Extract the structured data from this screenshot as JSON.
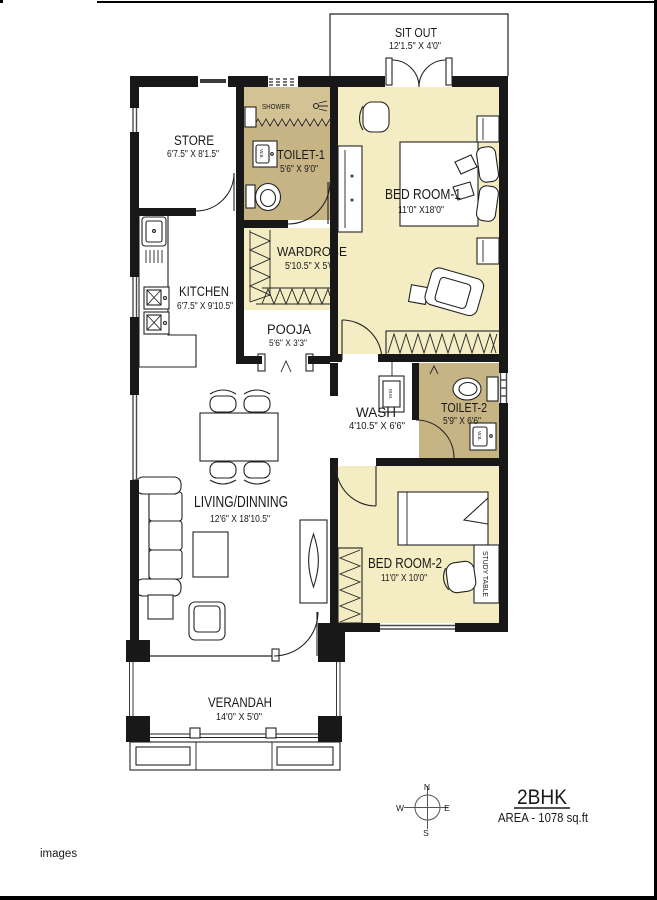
{
  "page": {
    "footer": "images"
  },
  "title_block": {
    "name": "2BHK",
    "area": "AREA - 1078 sq.ft"
  },
  "compass": {
    "n": "N",
    "s": "S",
    "e": "E",
    "w": "W"
  },
  "rooms": {
    "sit_out": {
      "label": "SIT OUT",
      "dims": "12'1.5\" X 4'0\""
    },
    "store": {
      "label": "STORE",
      "dims": "6'7.5\" X 8'1.5\""
    },
    "toilet1": {
      "label": "TOILET-1",
      "dims": "5'6\" X 9'0\""
    },
    "shower": {
      "label": "SHOWER"
    },
    "bed1": {
      "label": "BED ROOM-1",
      "dims": "11'0\" X18'0\""
    },
    "wardrobe": {
      "label": "WARDROBE",
      "dims": "5'10.5\" X 5'0\""
    },
    "kitchen": {
      "label": "KITCHEN",
      "dims": "6'7.5\" X 9'10.5\""
    },
    "pooja": {
      "label": "POOJA",
      "dims": "5'6\" X 3'3\""
    },
    "wash": {
      "label": "WASH",
      "dims": "4'10.5\" X 6'6\""
    },
    "toilet2": {
      "label": "TOILET-2",
      "dims": "5'9\" X 6'6\""
    },
    "living": {
      "label": "LIVING/DINNING",
      "dims": "12'6\" X 18'10.5\""
    },
    "bed2": {
      "label": "BED ROOM-2",
      "dims": "11'0\" X 10'0\""
    },
    "study": {
      "label": "STUDY TABLE"
    },
    "verandah": {
      "label": "VERANDAH",
      "dims": "14'0\" X 5'0\""
    }
  },
  "fixtures": {
    "wb1": "W.B.",
    "wb2": "W.B.",
    "wm": "W.M."
  },
  "colors": {
    "wall": "#181818",
    "toilet_fill": "#c6b485",
    "shower_fill": "#d2c294",
    "bedroom_fill": "#f4ecc3",
    "background": "#ffffff"
  }
}
